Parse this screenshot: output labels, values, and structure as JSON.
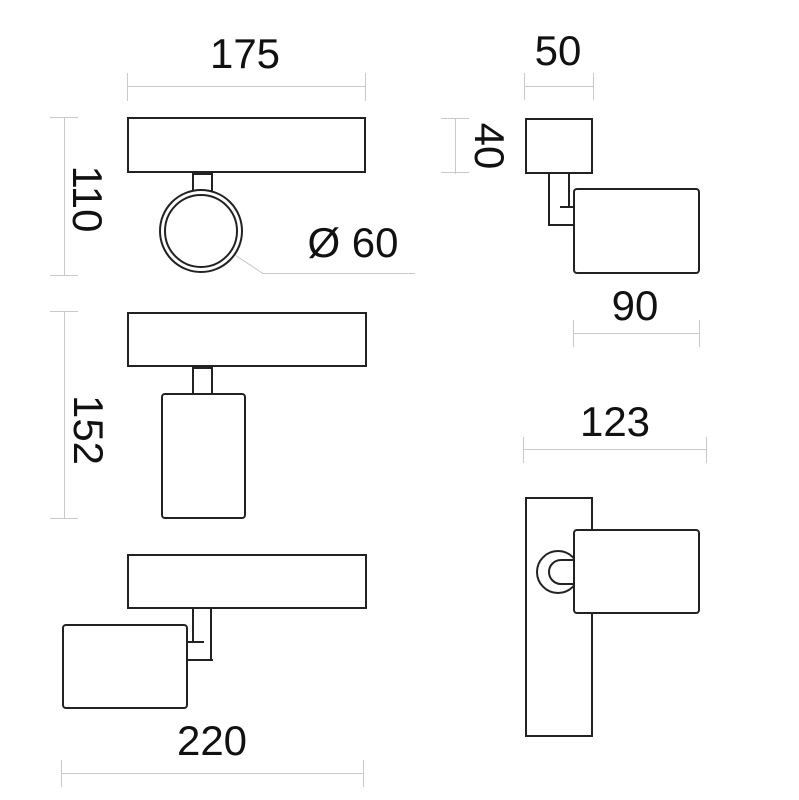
{
  "diagram": {
    "labels": {
      "front_width": "175",
      "front_height": "110",
      "diameter": "Ø 60",
      "front_total_height": "152",
      "overall_width": "220",
      "canopy_width": "50",
      "canopy_height": "40",
      "head_length": "90",
      "side_depth": "123"
    },
    "colors": {
      "object_line": "#222222",
      "dimension_line": "#c9c9c9",
      "label_text": "#111111",
      "background": "#ffffff"
    }
  }
}
